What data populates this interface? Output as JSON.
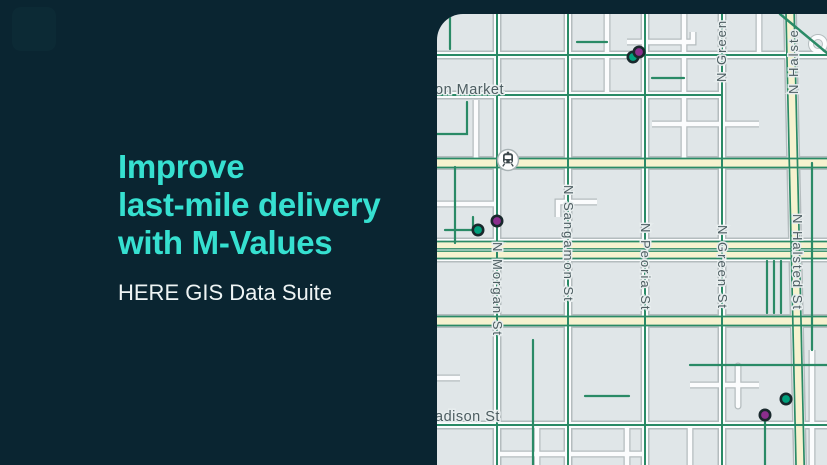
{
  "hero": {
    "title_line1": "Improve",
    "title_line2": "last-mile delivery",
    "title_line3": "with M-Values",
    "subtitle": "HERE GIS Data Suite"
  },
  "theme": {
    "background": "#0a2531",
    "accent": "#36e0d0",
    "subtitle_color": "#eef4f4",
    "map_background": "#e0e6e8",
    "road_casing": "#b4bcbe",
    "road_white": "#fbfcfd",
    "road_green": "#2a8a66",
    "road_yellow": "#f6f2cf",
    "street_label_color": "#4d5d61",
    "marker_purple": "#8b2e8d",
    "marker_teal": "#00a07c",
    "marker_outline": "#19282c"
  },
  "map": {
    "street_labels": [
      {
        "id": "market",
        "text": "on Market"
      },
      {
        "id": "madison",
        "text": "adison St"
      },
      {
        "id": "morgan",
        "text": "N Morgan St"
      },
      {
        "id": "sangamon",
        "text": "N Sangamon St"
      },
      {
        "id": "peoria",
        "text": "N Peoria St"
      },
      {
        "id": "green-mid",
        "text": "N Green St"
      },
      {
        "id": "halsted-mid",
        "text": "N Halsted St"
      },
      {
        "id": "green-top",
        "text": "N Green"
      },
      {
        "id": "halsted-top",
        "text": "N Halste"
      }
    ],
    "markers": [
      {
        "color": "teal",
        "x": 196,
        "y": 43
      },
      {
        "color": "purple",
        "x": 202,
        "y": 38
      },
      {
        "color": "purple",
        "x": 60,
        "y": 207
      },
      {
        "color": "teal",
        "x": 41,
        "y": 216
      },
      {
        "color": "teal",
        "x": 349,
        "y": 385
      },
      {
        "color": "purple",
        "x": 328,
        "y": 401
      }
    ],
    "poi": {
      "name": "transit-station"
    }
  }
}
